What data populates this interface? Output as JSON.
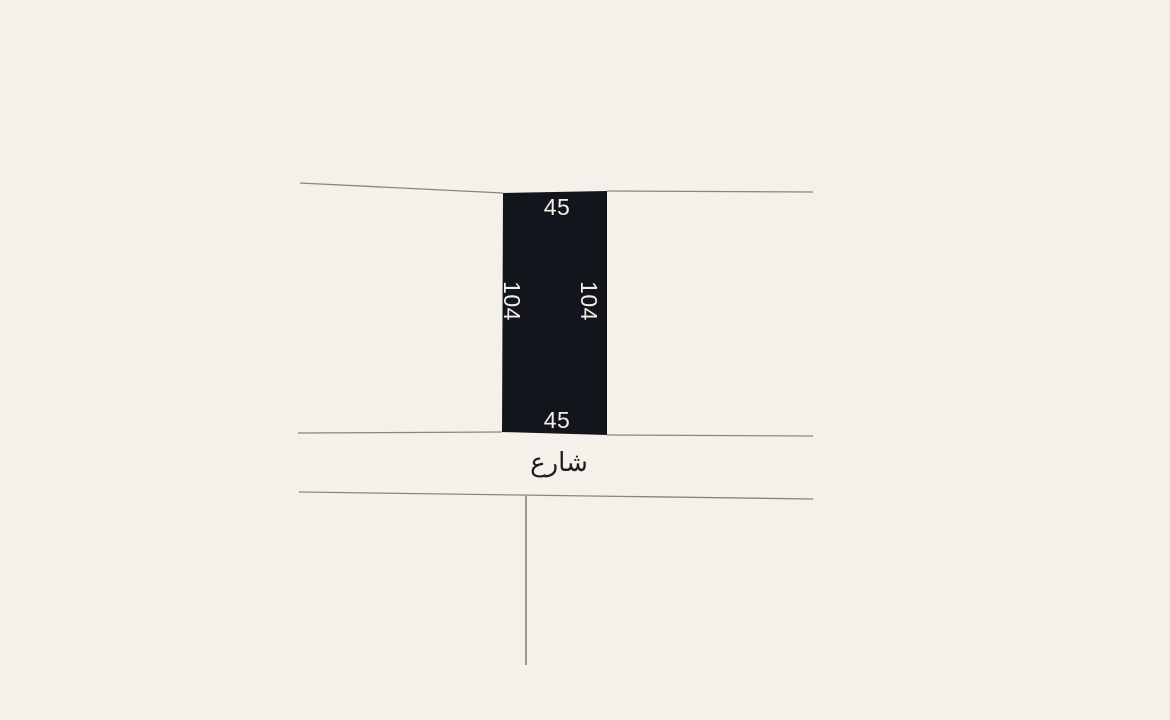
{
  "plot": {
    "top_dimension": "45",
    "bottom_dimension": "45",
    "left_dimension": "104",
    "right_dimension": "104"
  },
  "street": {
    "label": "شارع"
  },
  "colors": {
    "background": "#f5f0e9",
    "plot_fill": "#13151d",
    "plot_label": "#f3efe8",
    "boundary_line": "#8b8578",
    "street_label": "#1e1e1e"
  }
}
